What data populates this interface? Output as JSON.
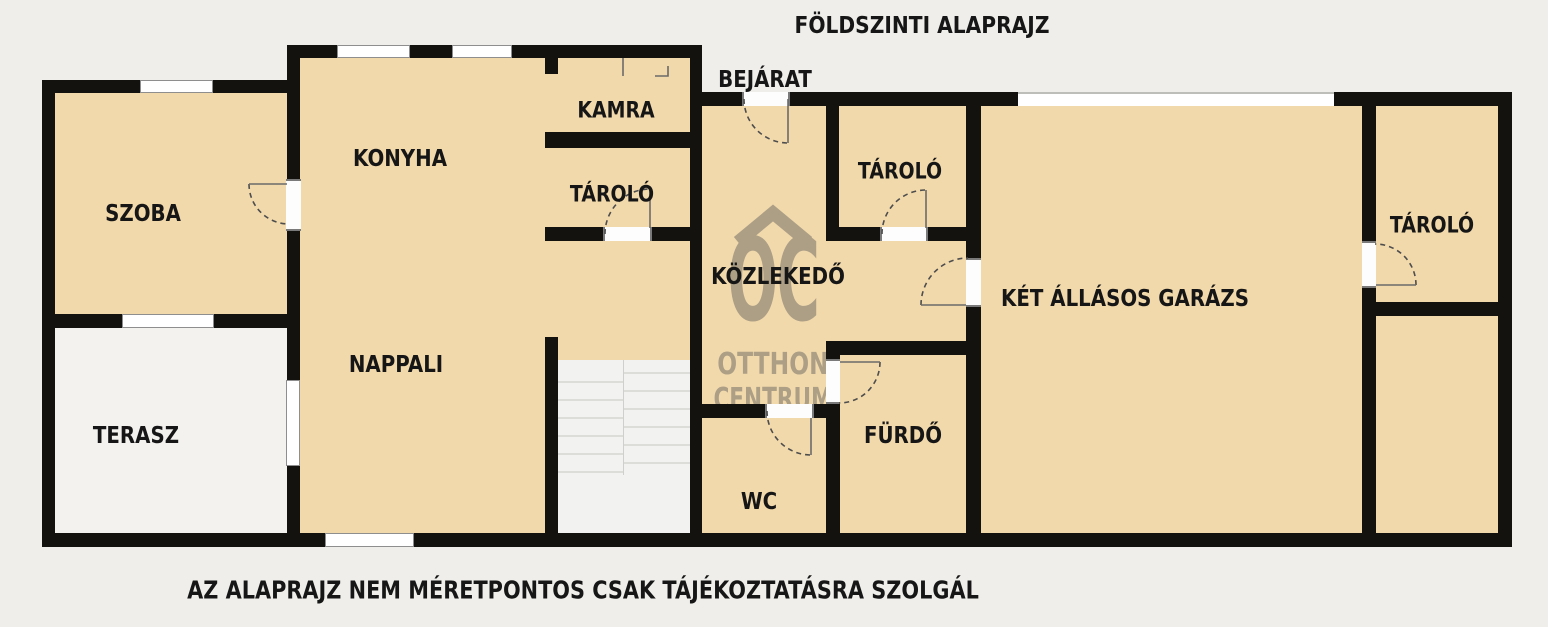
{
  "title": "FÖLDSZINTI ALAPRAJZ",
  "disclaimer": "AZ ALAPRAJZ NEM MÉRETPONTOS CSAK TÁJÉKOZTATÁSRA SZOLGÁL",
  "watermark": {
    "logo": "OC",
    "line1": "OTTHON",
    "line2": "CENTRUM"
  },
  "rooms": {
    "szoba": {
      "label": "SZOBA"
    },
    "konyha": {
      "label": "KONYHA"
    },
    "kamra": {
      "label": "KAMRA"
    },
    "tarolo_left": {
      "label": "TÁROLÓ"
    },
    "bejarat": {
      "label": "BEJÁRAT"
    },
    "tarolo_middle": {
      "label": "TÁROLÓ"
    },
    "kozlekedo": {
      "label": "KÖZLEKEDŐ"
    },
    "garazs": {
      "label": "KÉT ÁLLÁSOS GARÁZS"
    },
    "tarolo_right": {
      "label": "TÁROLÓ"
    },
    "nappali": {
      "label": "NAPPALI"
    },
    "terasz": {
      "label": "TERASZ"
    },
    "furdo": {
      "label": "FÜRDŐ"
    },
    "wc": {
      "label": "WC"
    }
  },
  "colors": {
    "background": "#efeeea",
    "floor": "#f2d9ab",
    "terrace_floor": "#f3f2ef",
    "wall": "#14120f",
    "watermark": "#a09680",
    "stairs": "#f2f2f0"
  }
}
